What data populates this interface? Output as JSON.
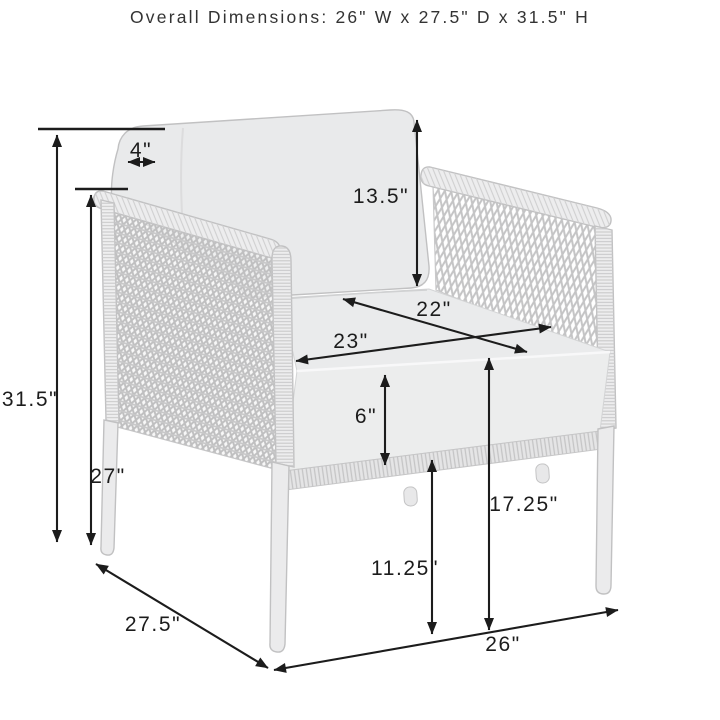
{
  "title": "Overall Dimensions: 26\" W x 27.5\" D x 31.5\" H",
  "diagram": {
    "subject": "outdoor woven wicker armchair with back and seat cushions",
    "dimensions": {
      "overall_height": "31.5\"",
      "arm_height": "27\"",
      "back_cushion_top_thickness": "4\"",
      "back_cushion_height": "13.5\"",
      "seat_width": "22\"",
      "seat_depth": "23\"",
      "seat_cushion_thickness": "6\"",
      "seat_height": "17.25\"",
      "under_seat_clearance": "11.25\"",
      "overall_depth": "27.5\"",
      "overall_width": "26\""
    },
    "colors": {
      "background": "#ffffff",
      "annotation": "#1c1c1c",
      "title_text": "#333333",
      "chair_outline": "#c1c1c2",
      "cushion_fill": "#e9eaeb"
    }
  }
}
